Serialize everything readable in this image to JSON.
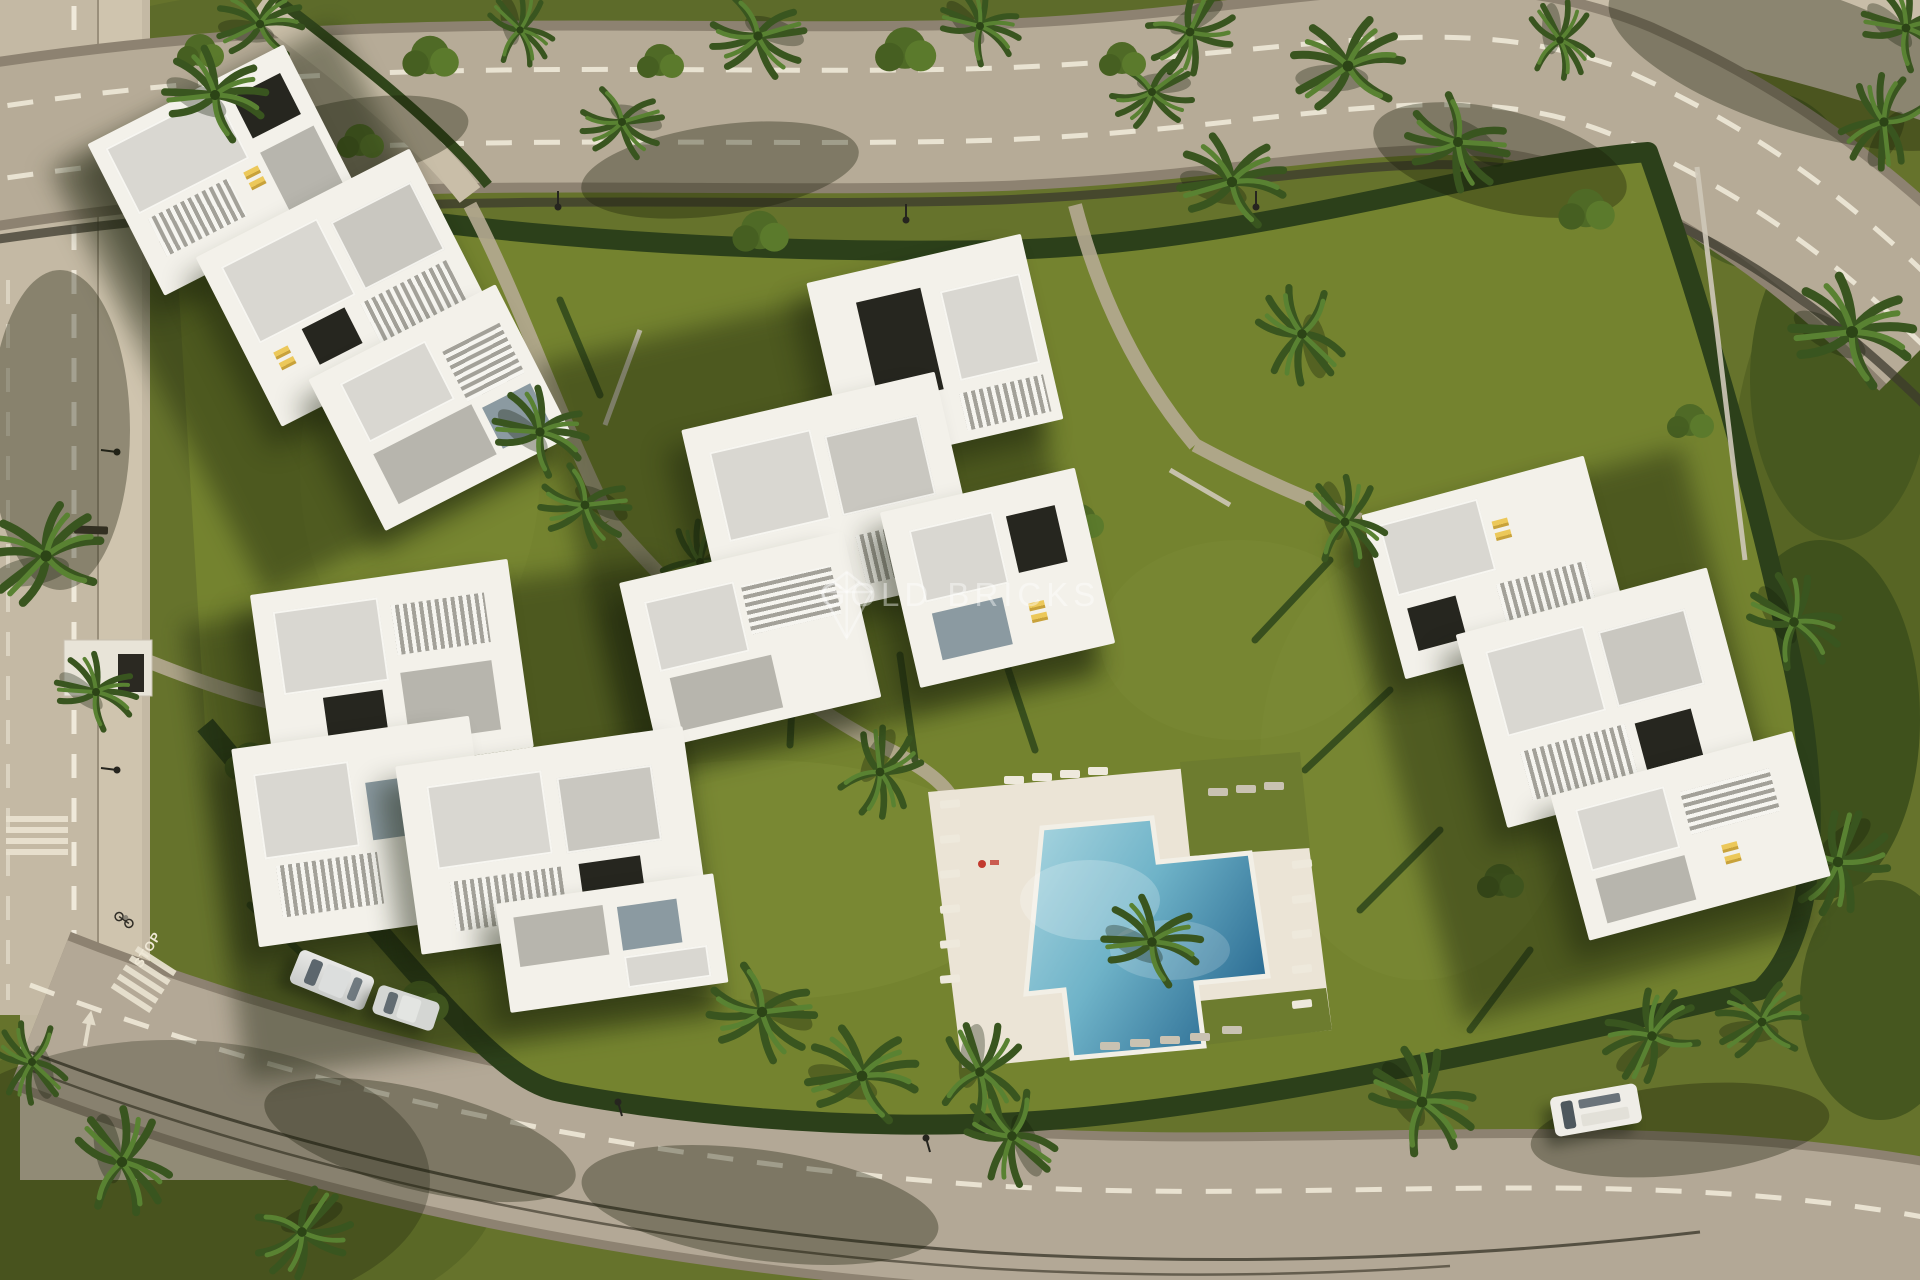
{
  "scene": {
    "description": "Top-down aerial 3D render of a gated residential complex: four white modern apartment buildings with roof terraces and yellow sun loungers, landscaped gardens with palm trees and hedges, a cross-shaped swimming pool with white sun deck, perimeter hedge walls and curving asphalt roads with dashed lane lines, crosswalks and parked cars",
    "watermark": {
      "text": "GOLD BRICKS",
      "logo": "diamond-monogram-watermark"
    },
    "road_markings": {
      "stop": "STOP"
    },
    "counts": {
      "buildings": 4,
      "swimming_pools": 1,
      "parked_cars": 3
    },
    "colors": {
      "grass": "#66732c",
      "inner_lawn": "#74832f",
      "hedge": "#2c401a",
      "road": "#b6ab97",
      "side_road": "#c4b9a4",
      "building_white": "#f3f1ea",
      "roof_gray": "#d9d7d1",
      "pool_light": "#aad6e0",
      "pool_deep": "#2f7096",
      "deck": "#ebe4d6",
      "lounger_yellow": "#ecc85a",
      "watermark_white": "rgba(255,255,255,0.4)"
    }
  }
}
